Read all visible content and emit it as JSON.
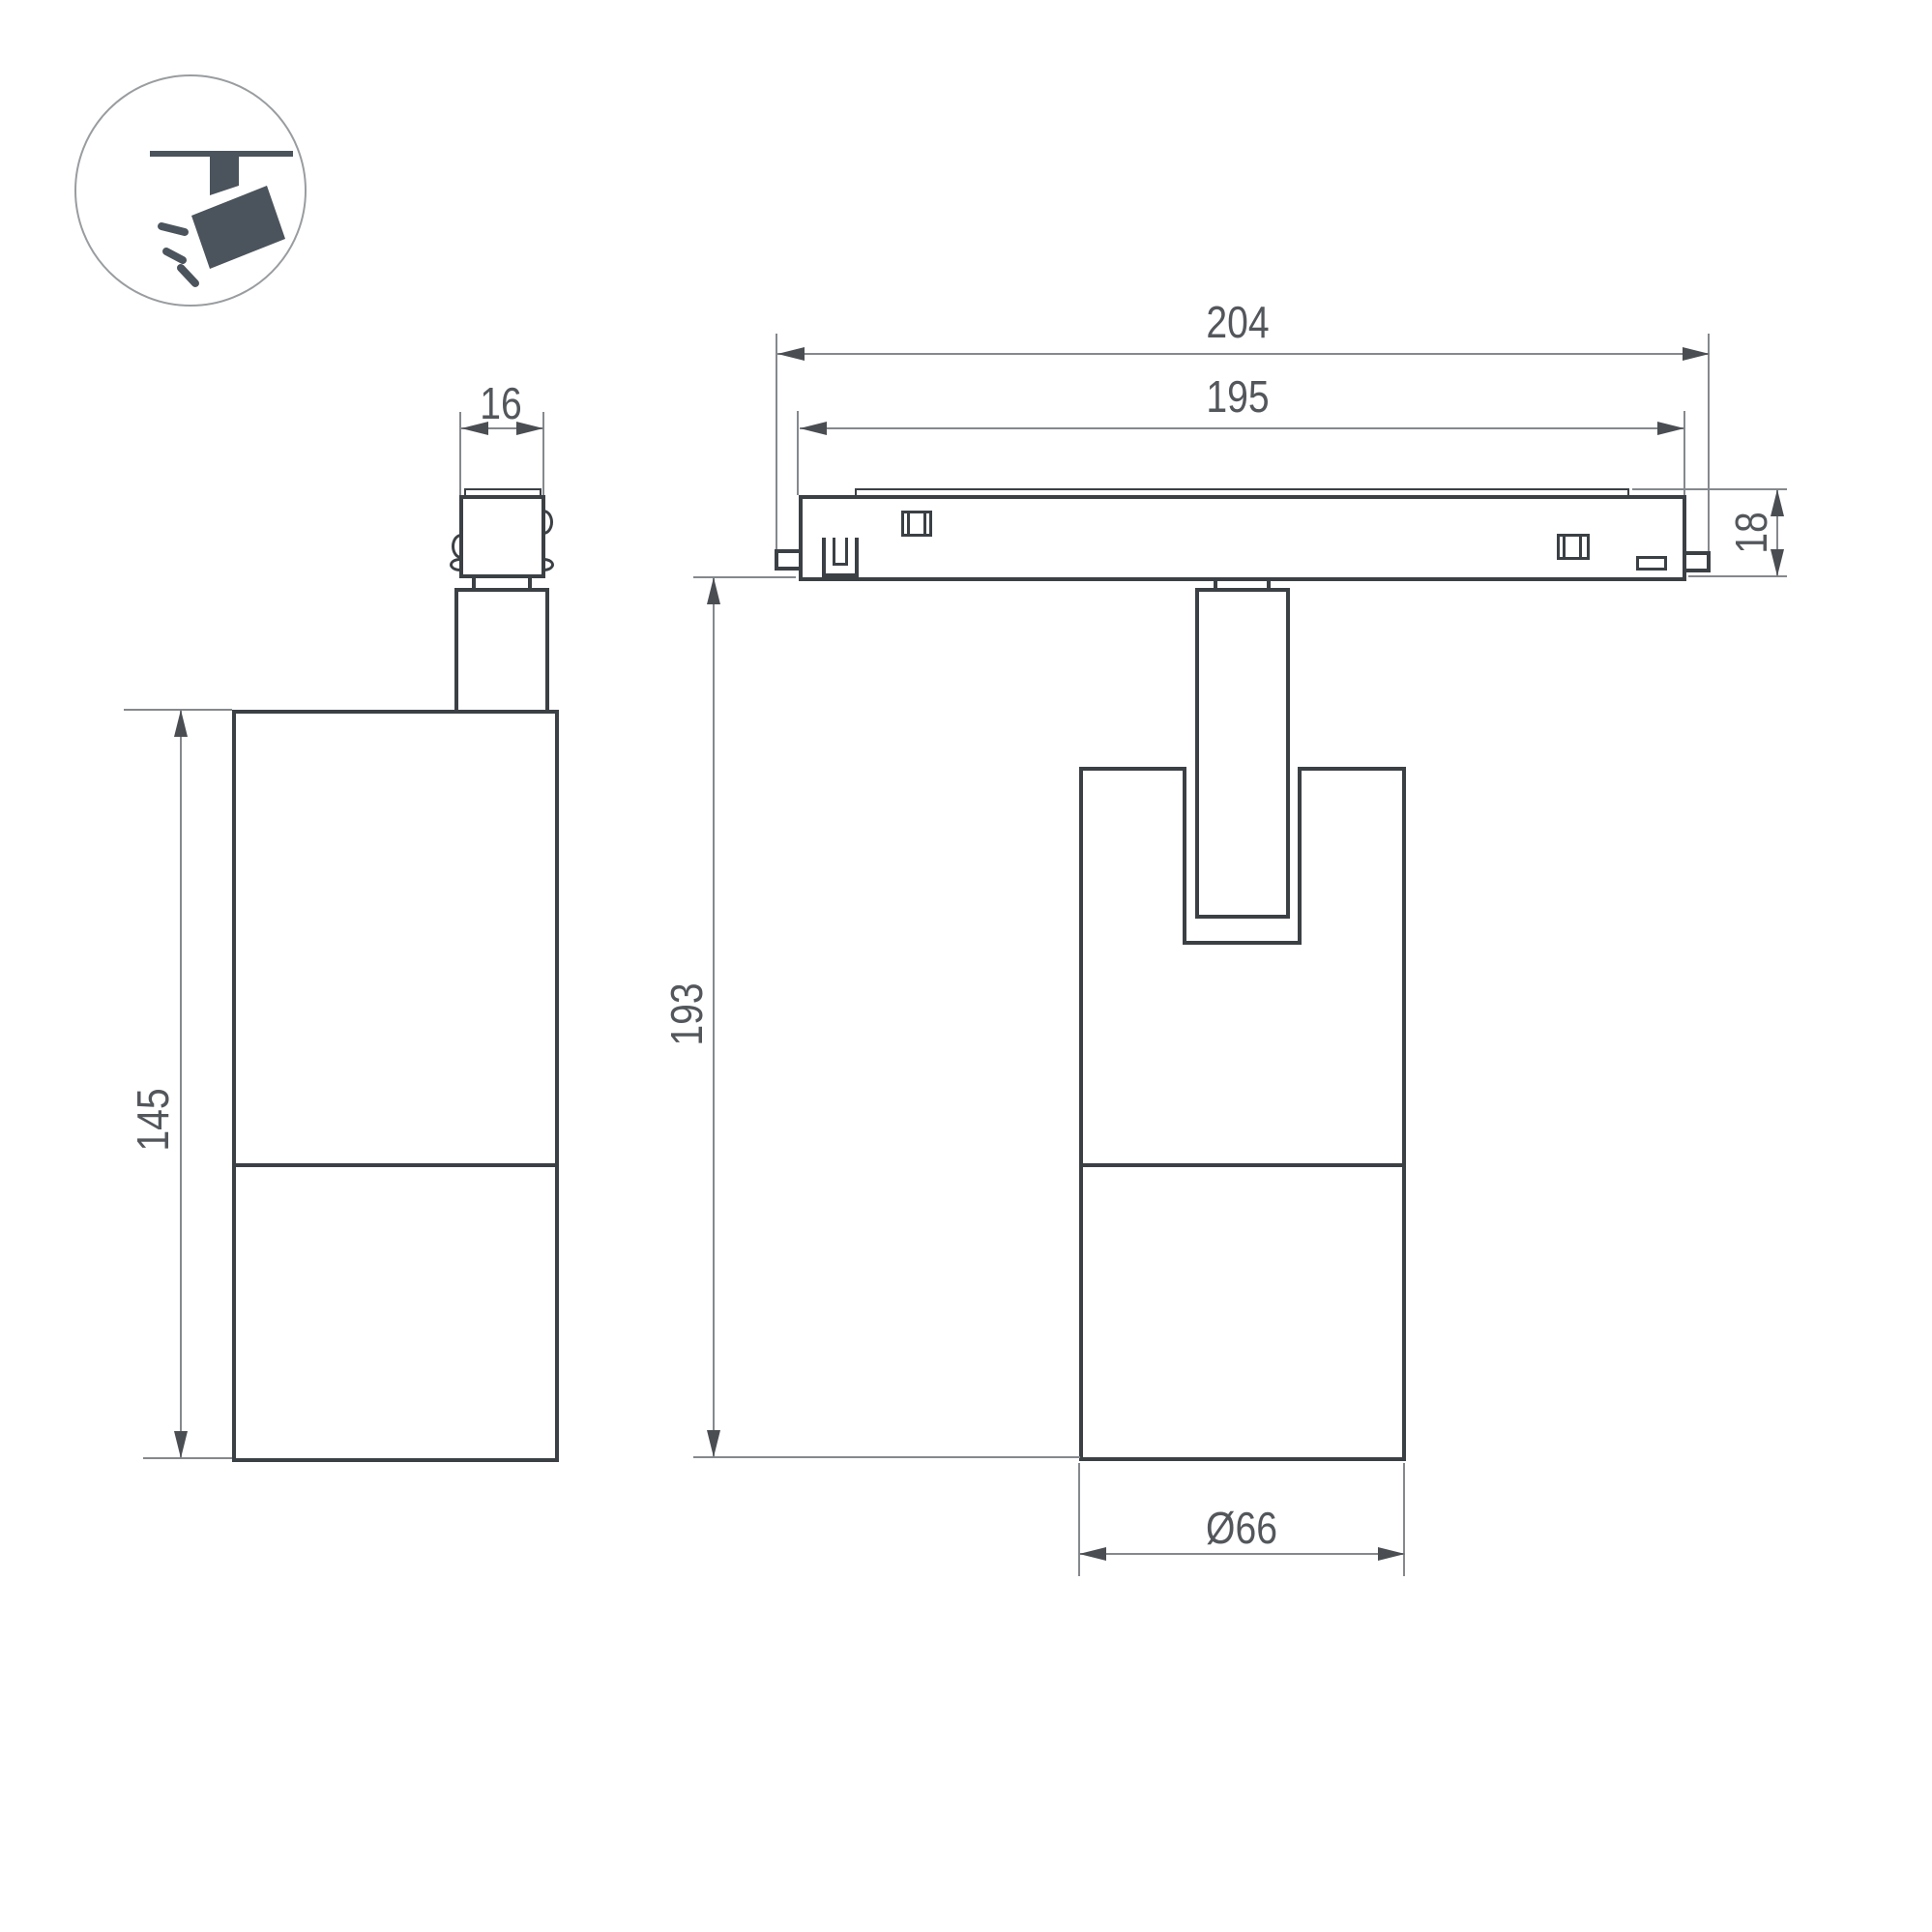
{
  "colors": {
    "outline": "#3b4045",
    "dimension": "#85898d",
    "arrow": "#4a4e53",
    "text": "#53575c",
    "icon": "#4b545c",
    "circle": "#999da0",
    "bg": "#ffffff"
  },
  "icons": {
    "mount_pictogram": "track-spotlight-icon"
  },
  "drawing": {
    "type": "technical-dimension-drawing",
    "side_view": {
      "adapter_width": "16",
      "body_height": "145"
    },
    "front_view": {
      "overall_length": "204",
      "track_length": "195",
      "track_height": "18",
      "total_height": "193",
      "body_diameter": "Ø66"
    }
  }
}
